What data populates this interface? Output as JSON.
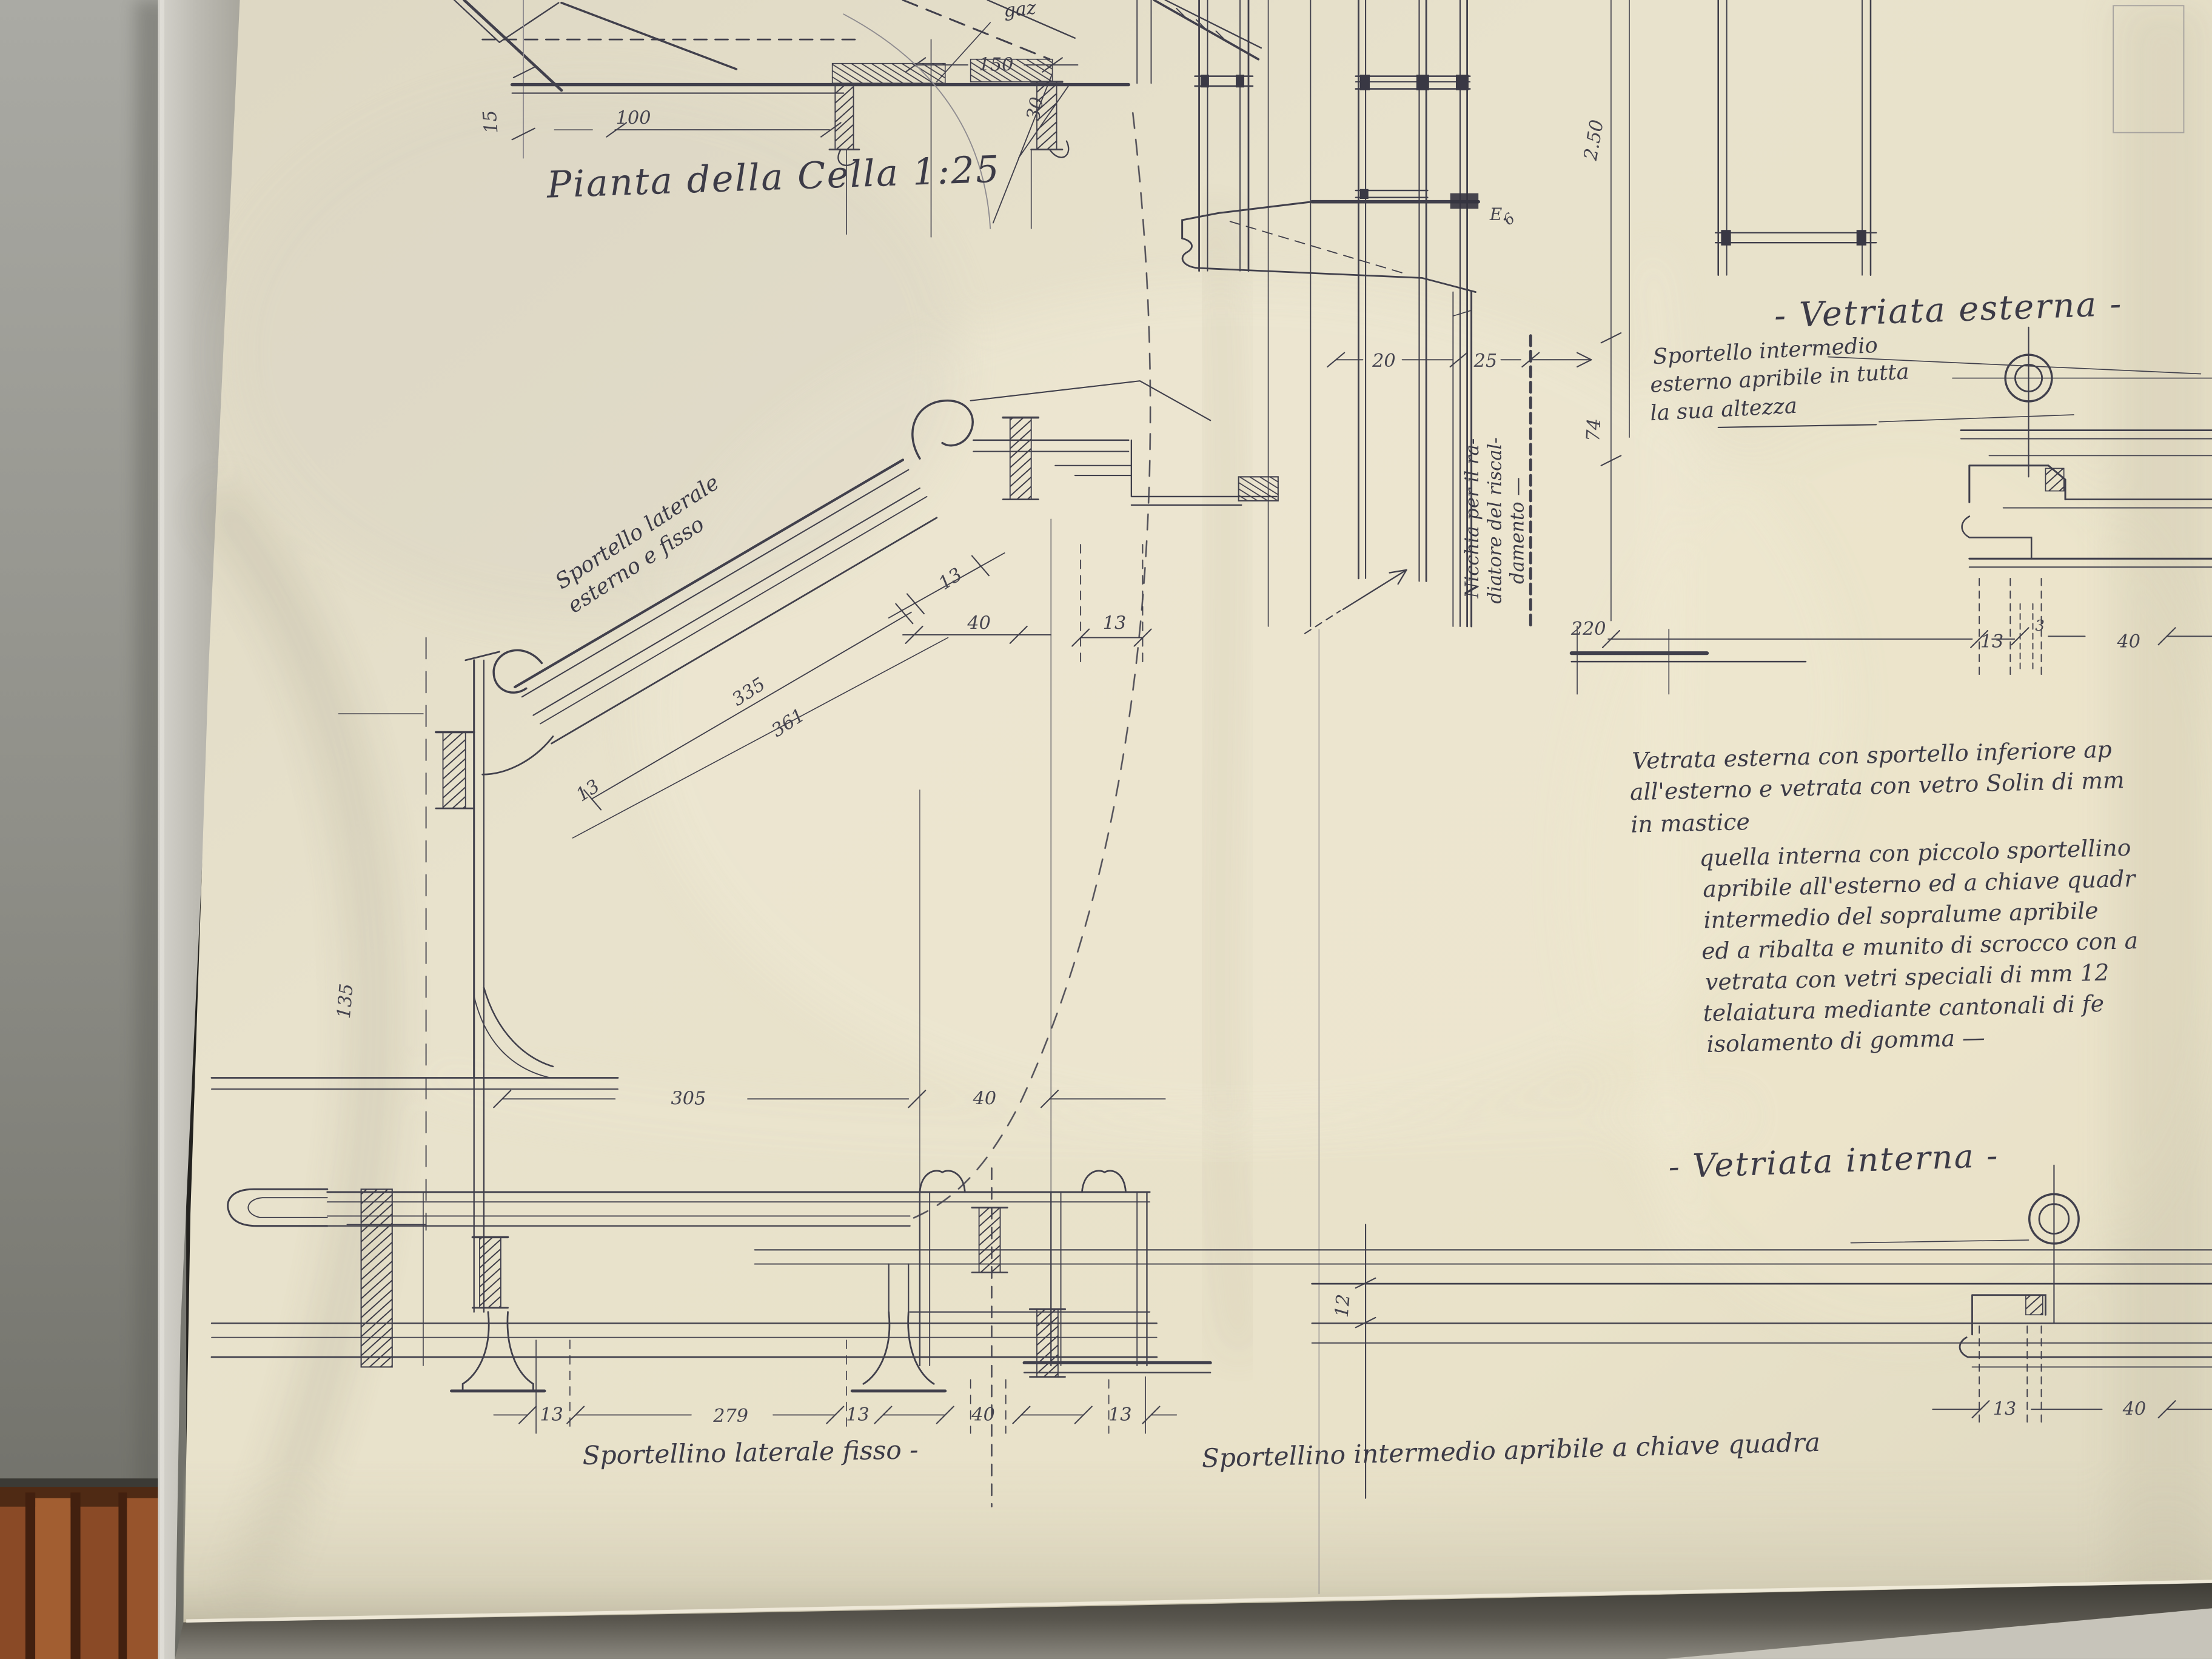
{
  "palette": {
    "wall_top": "#a9a9a3",
    "wall_bottom": "#6e6e67",
    "paper": "#e6e0ca",
    "paper_bright": "#efe9d5",
    "paper_shadow": "#cfc9b2",
    "backing_strip": "#c0beb6",
    "ink": "#41404c",
    "pencil": "#8f8c90",
    "floor_wood": "#8a4a26",
    "floor_wood_light": "#a25e31",
    "floor_gap": "#42200f",
    "table_edge": "#56534b"
  },
  "titles": {
    "plan": "Pianta della Cella 1:25",
    "external": "- Vetriata esterna -",
    "internal": "- Vetriata interna -"
  },
  "labels": {
    "gaz": "gaz",
    "side_shutter_1": "Sportello laterale",
    "side_shutter_2": "esterno e fisso",
    "mid_shutter_1": "Sportello intermedio",
    "mid_shutter_2": "esterno apribile in tutta",
    "mid_shutter_3": "la sua altezza",
    "niche_1": "Nicchia per il ra-",
    "niche_2": "diatore del riscal-",
    "niche_3": "damento —",
    "bottom_left_caption": "Sportellino laterale fisso -",
    "bottom_right_caption": "Sportellino intermedio apribile a chiave quadra"
  },
  "notes": [
    "Vetrata esterna con sportello inferiore ap",
    "all'esterno  e vetrata con vetro Solin di mm",
    "in mastice",
    "quella interna  con piccolo sportellino",
    "apribile all'esterno ed a chiave quadr",
    "intermedio del sopralume  apribile",
    "ed a ribalta e munito di  scrocco con a",
    "vetrata con vetri speciali  di mm 12",
    "telaiatura  mediante  cantonali di fe",
    "isolamento di gomma —"
  ],
  "dims": [
    "150",
    "100",
    "15",
    "30",
    "2.50",
    "E.",
    "6",
    "20",
    "25",
    "74",
    "13",
    "40",
    "13",
    "335",
    "361",
    "13",
    "135",
    "220",
    "13",
    "3",
    "40",
    "305",
    "40",
    "12",
    "13",
    "279",
    "13",
    "40",
    "13",
    "13",
    "40"
  ]
}
